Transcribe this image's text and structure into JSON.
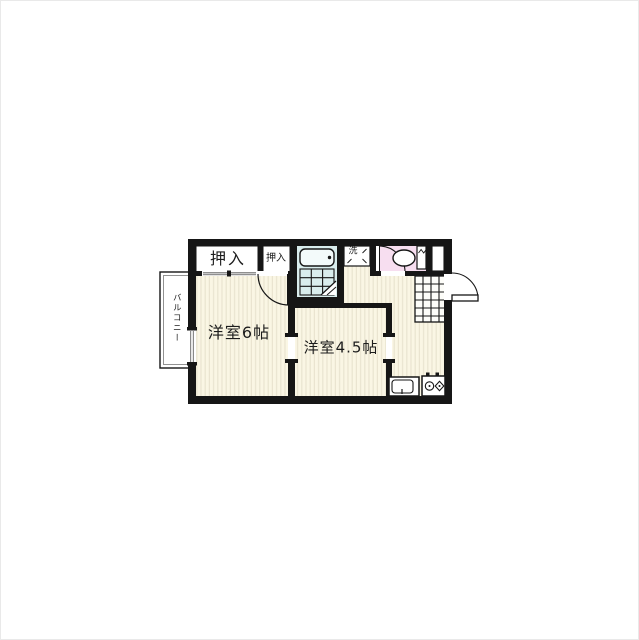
{
  "labels": {
    "closet_large": "押入",
    "closet_small": "押入",
    "laundry": "洗",
    "balcony": "バルコニー",
    "room_main": "洋室6帖",
    "room_second": "洋室4.5帖"
  },
  "colors": {
    "wall": "#161616",
    "floor": "#faf6e4",
    "floor_stripe": "#e9e4cf",
    "bath": "#d9eded",
    "toilet_pink": "#f7def0",
    "door_gray": "#8f8f8f"
  },
  "fixtures": [
    "bathtub",
    "bath-tile-floor",
    "bath-folding-door",
    "washing-machine-space",
    "toilet",
    "shoe-cabinet",
    "entry-tile-floor",
    "entrance-door",
    "room-hinged-door",
    "closet-sliding-door",
    "balcony-window",
    "kitchen-sink",
    "two-burner-stove"
  ]
}
